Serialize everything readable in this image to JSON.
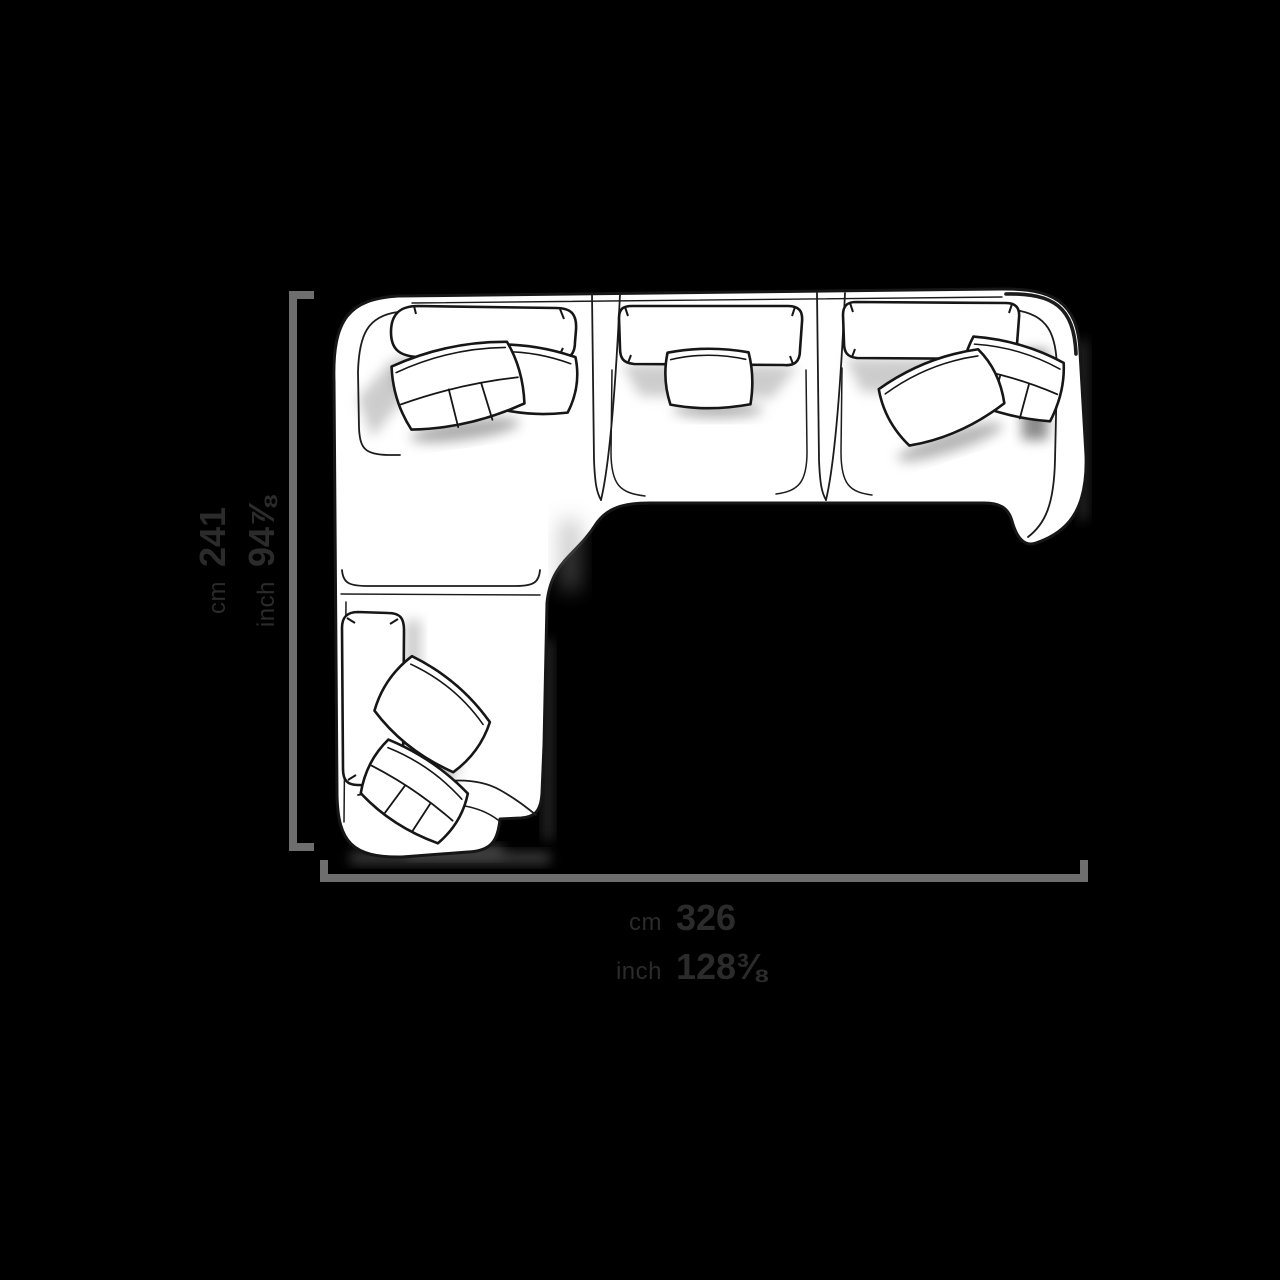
{
  "canvas": {
    "background_color": "#000000"
  },
  "drawing": {
    "subject": "corner-sofa-with-chaise-top-view",
    "style": "hand-drawn-sketch",
    "stroke_color": "#1a1a1a",
    "fill_color": "#ffffff",
    "shadow_color": "#8a8a8a",
    "sections": [
      "corner-seat-with-left-arm",
      "middle-seat",
      "right-seat-with-right-arm",
      "chaise-longue"
    ],
    "pillow_count": 7
  },
  "dimension_lines": {
    "color": "#6e6e6e",
    "thickness_px": 8
  },
  "labels": {
    "text_color": "#2b2b2b",
    "width_dimension": {
      "unit_metric": "cm",
      "value_metric": "326",
      "unit_imperial": "inch",
      "value_imperial": "128⅜"
    },
    "depth_dimension": {
      "unit_metric": "cm",
      "value_metric": "241",
      "unit_imperial": "inch",
      "value_imperial": "94⅞"
    }
  }
}
